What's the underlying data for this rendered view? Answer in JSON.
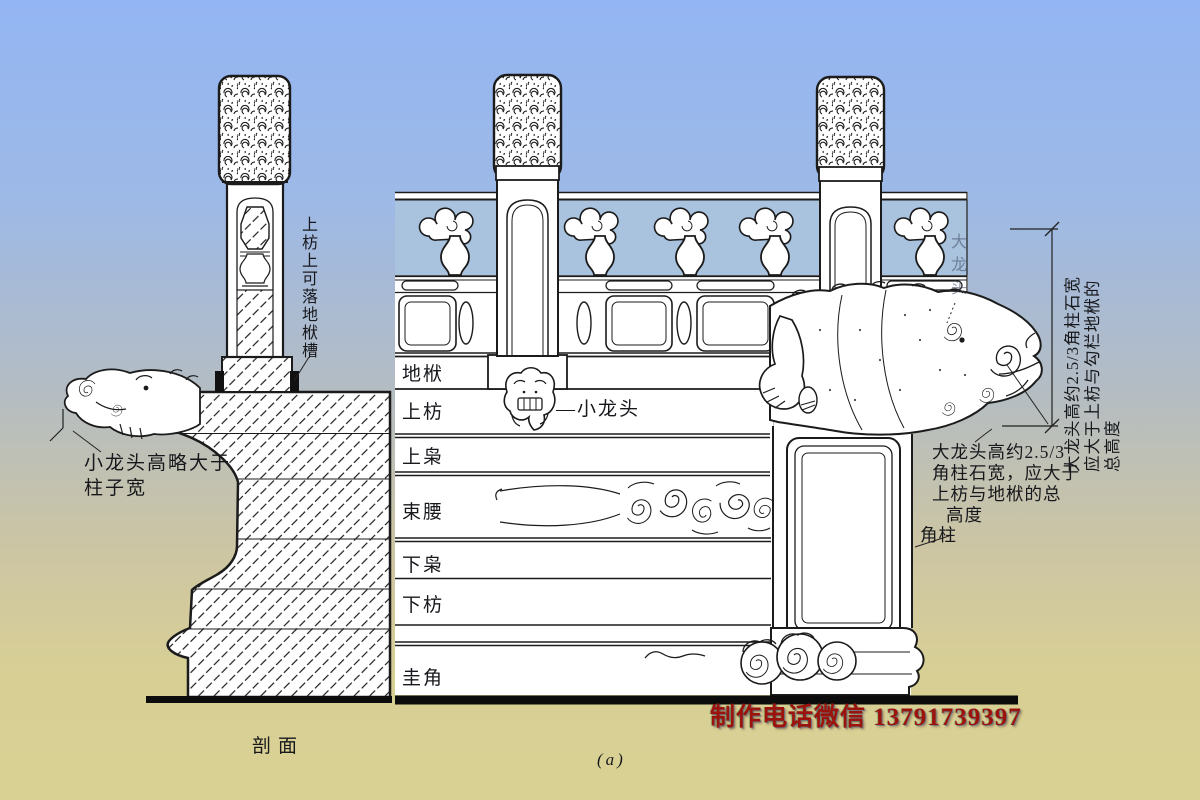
{
  "background": {
    "sky_color": "#93b5f3",
    "ground_color": "#d9d094"
  },
  "drawing": {
    "line_color": "#1b1b1b",
    "paper_color": "#ffffff",
    "opening_color": "#a9c2de"
  },
  "section_view": {
    "caption": "剖面",
    "groove_note": "上枋上可落地栿槽",
    "dragon_note": [
      "小龙头高略大于",
      "柱子宽"
    ]
  },
  "elevation_view": {
    "caption": "(a)",
    "band_labels": [
      "地栿",
      "上枋",
      "上枭",
      "束腰",
      "下枭",
      "下枋",
      "圭角"
    ],
    "small_dragon_head_label": "—小龙头",
    "big_dragon_head_label": "大龙头",
    "rotated_note": [
      "大龙头高约2.5/3角柱石宽",
      "应大于上枋与勾栏地栿的",
      "总高度"
    ],
    "side_note": [
      "大龙头高约2.5/3",
      "角柱石宽，应大于",
      "上枋与地栿的总",
      "高度"
    ],
    "corner_post_label": "角柱"
  },
  "watermark": {
    "text": "制作电话微信 13791739397",
    "color": "#9c120c"
  }
}
